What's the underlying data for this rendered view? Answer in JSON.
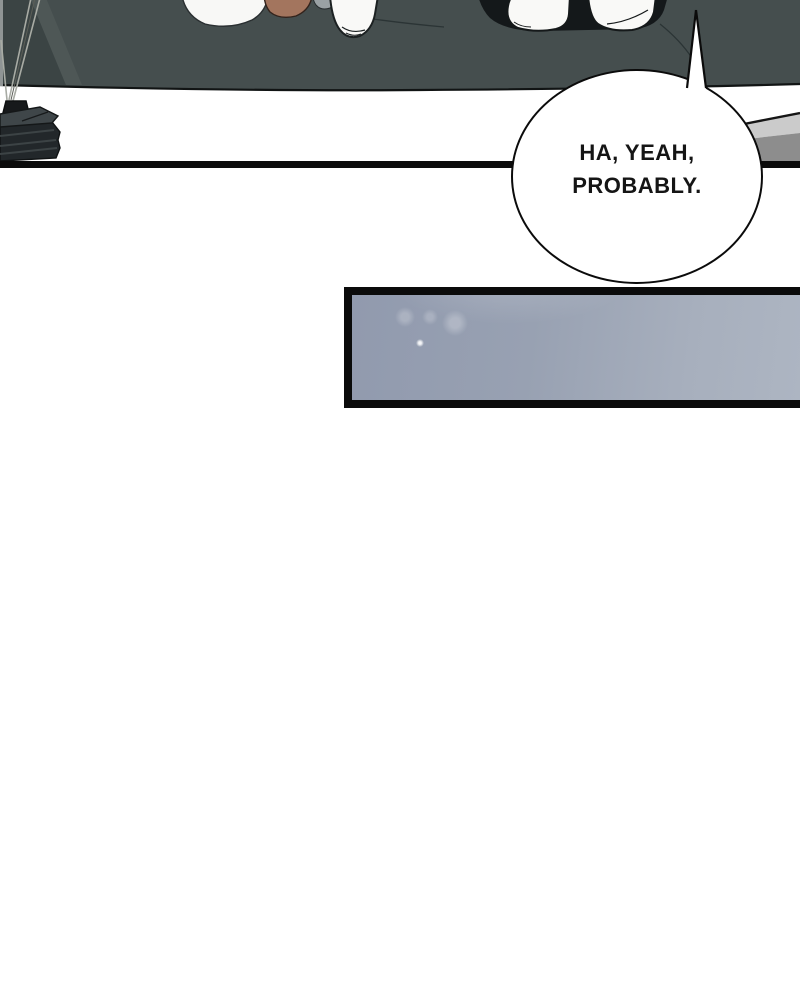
{
  "dialogue_bubble": {
    "line1": "HA, YEAH,",
    "line2": "PROBABLY."
  },
  "colors": {
    "ink": "#0b0b0b",
    "couch": "#454e4e",
    "couch_dark": "#3b4444",
    "couch_light": "#4e5756",
    "sock_white": "#f9f9f7",
    "hair_brown": "#a3755e",
    "pants_black": "#14181a",
    "book_top": "#3f4649",
    "book_side": "#22272a",
    "book_ridge": "#3c4345",
    "table_light": "#cbcbcb",
    "table_mid": "#8d8d8d",
    "panel_left": "#919aae",
    "panel_right": "#adb5c2"
  }
}
